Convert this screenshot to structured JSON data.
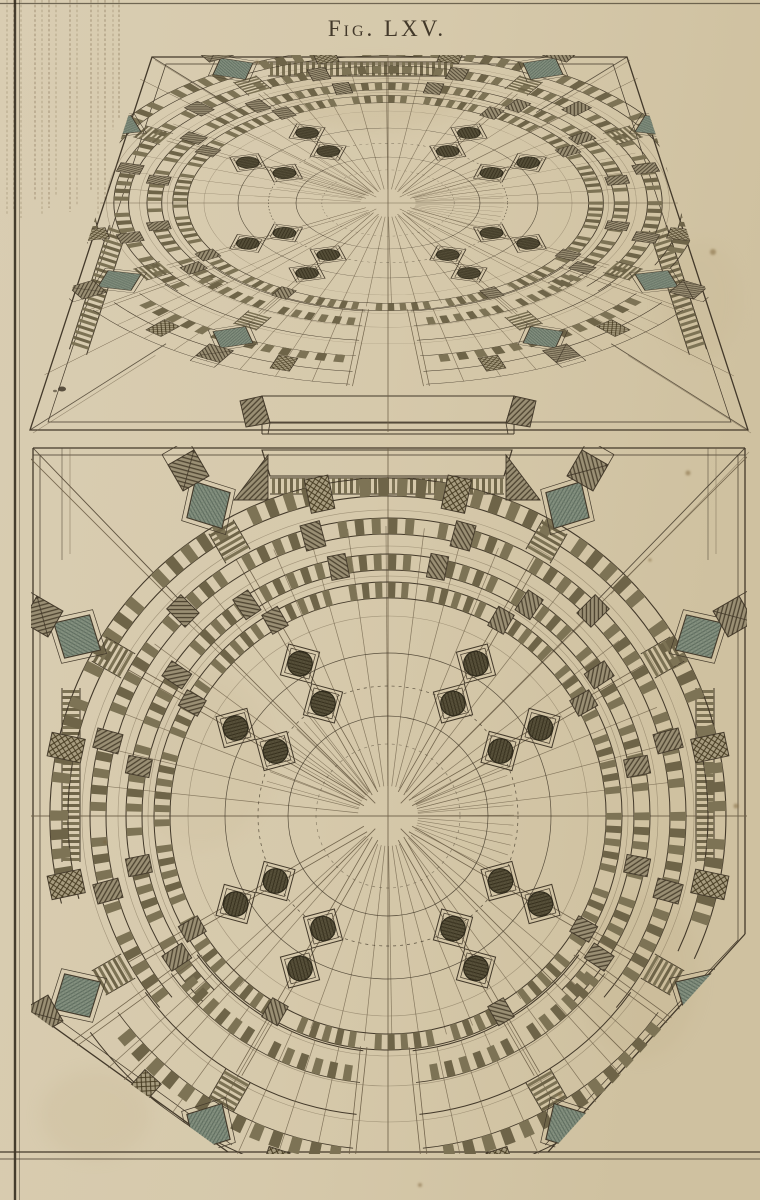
{
  "title": "Fig. LXV.",
  "colors": {
    "paper": "#d6c9ab",
    "paper_light": "#d9cdb2",
    "paper_dark": "#cfc1a0",
    "ink": "#43392a",
    "ink_light": "#6f6149",
    "tread": "#6e6448",
    "tread_alt": "#7d7355",
    "hatch": "#4d4330",
    "teal": "#84907f",
    "teal_line": "#5c6a5d",
    "column": "#57503a",
    "stain": "#b9a67e",
    "striation": "#8a795b"
  },
  "views": {
    "perspective": {
      "label": "upper foreshortened view",
      "cx": 388,
      "cy": 203,
      "sx": 0.92,
      "sy": 0.46,
      "pedestal_r": 340,
      "frame_far": [
        [
          152,
          57
        ],
        [
          627,
          57
        ]
      ],
      "frame_near": [
        [
          30,
          430
        ],
        [
          748,
          430
        ]
      ]
    },
    "plan": {
      "label": "lower plan view",
      "cx": 388,
      "cy": 816,
      "sx": 1,
      "sy": 1,
      "pedestal_r": 362,
      "frame_top_y": 448,
      "frame_bottom_y": 1152,
      "frame_left_x": 33,
      "frame_right_x": 745,
      "chamfer_left": [
        [
          33,
          1012
        ],
        [
          228,
          1152
        ]
      ],
      "chamfer_right": [
        [
          745,
          934
        ],
        [
          548,
          1152
        ]
      ]
    }
  },
  "structure": {
    "column_axes_deg": [
      -150,
      -120,
      -60,
      -30,
      30,
      60,
      120,
      150
    ],
    "column_radii": [
      130,
      176
    ],
    "ring_bands": [
      [
        218,
        234
      ],
      [
        246,
        262
      ],
      [
        282,
        298
      ],
      [
        320,
        338
      ]
    ],
    "construction_ring_radii": [
      200,
      240,
      270,
      306
    ],
    "inner_circle_radii": [
      72,
      100,
      130,
      163
    ],
    "fan_sectors_deg": [
      [
        36,
        84
      ],
      [
        96,
        144
      ]
    ]
  }
}
